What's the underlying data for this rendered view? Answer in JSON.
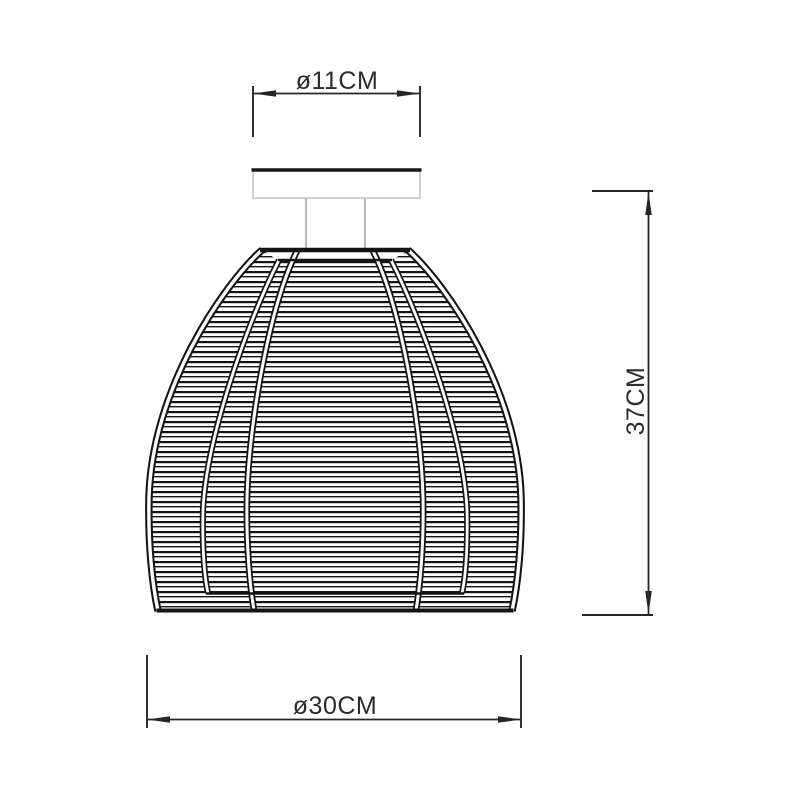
{
  "drawing": {
    "title": "ceiling-lamp-dimension-drawing",
    "dimensions": {
      "canopy_diameter": {
        "label": "ø11CM"
      },
      "height": {
        "label": "37CM"
      },
      "shade_diameter": {
        "label": "ø30CM"
      }
    },
    "colors": {
      "line": "#1a1a1a",
      "dimension_line": "#262626",
      "canopy_outline": "#c6c6c6",
      "stem": "#b5b5b5",
      "background": "#ffffff"
    }
  }
}
